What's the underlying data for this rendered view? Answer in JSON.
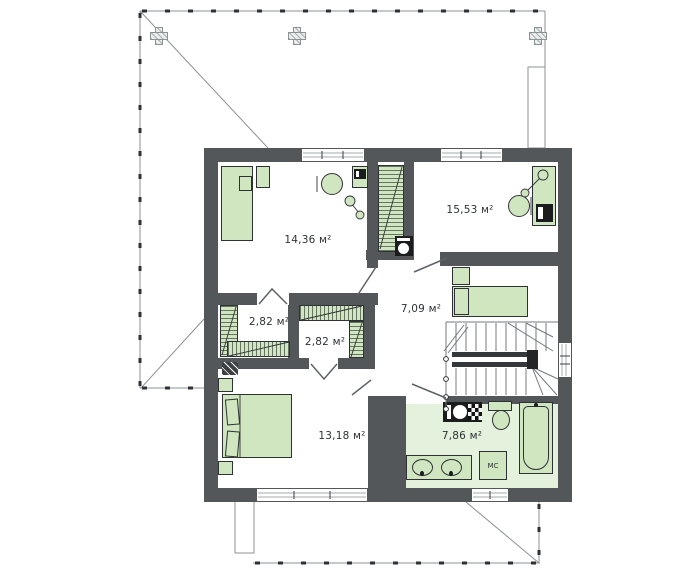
{
  "plan": {
    "type": "floor-plan",
    "units": "м²"
  },
  "rooms": [
    {
      "id": "bedroom-top-left",
      "area_label": "14,36 м²"
    },
    {
      "id": "bedroom-top-right",
      "area_label": "15,53 м²"
    },
    {
      "id": "hall",
      "area_label": "7,09 м²"
    },
    {
      "id": "closet-left",
      "area_label": "2,82 м²"
    },
    {
      "id": "closet-center",
      "area_label": "2,82 м²"
    },
    {
      "id": "bedroom-bottom",
      "area_label": "13,18 м²"
    },
    {
      "id": "bathroom",
      "area_label": "7,86 м²"
    }
  ],
  "fixtures": {
    "washing_machine_label": "МС"
  },
  "colors": {
    "wall": "#53575a",
    "furniture_fill": "#cfe6c0",
    "furniture_border": "#2f3234",
    "bathroom_floor": "#e4f1dc",
    "roof_line": "#8d9294",
    "text": "#2f3234"
  }
}
